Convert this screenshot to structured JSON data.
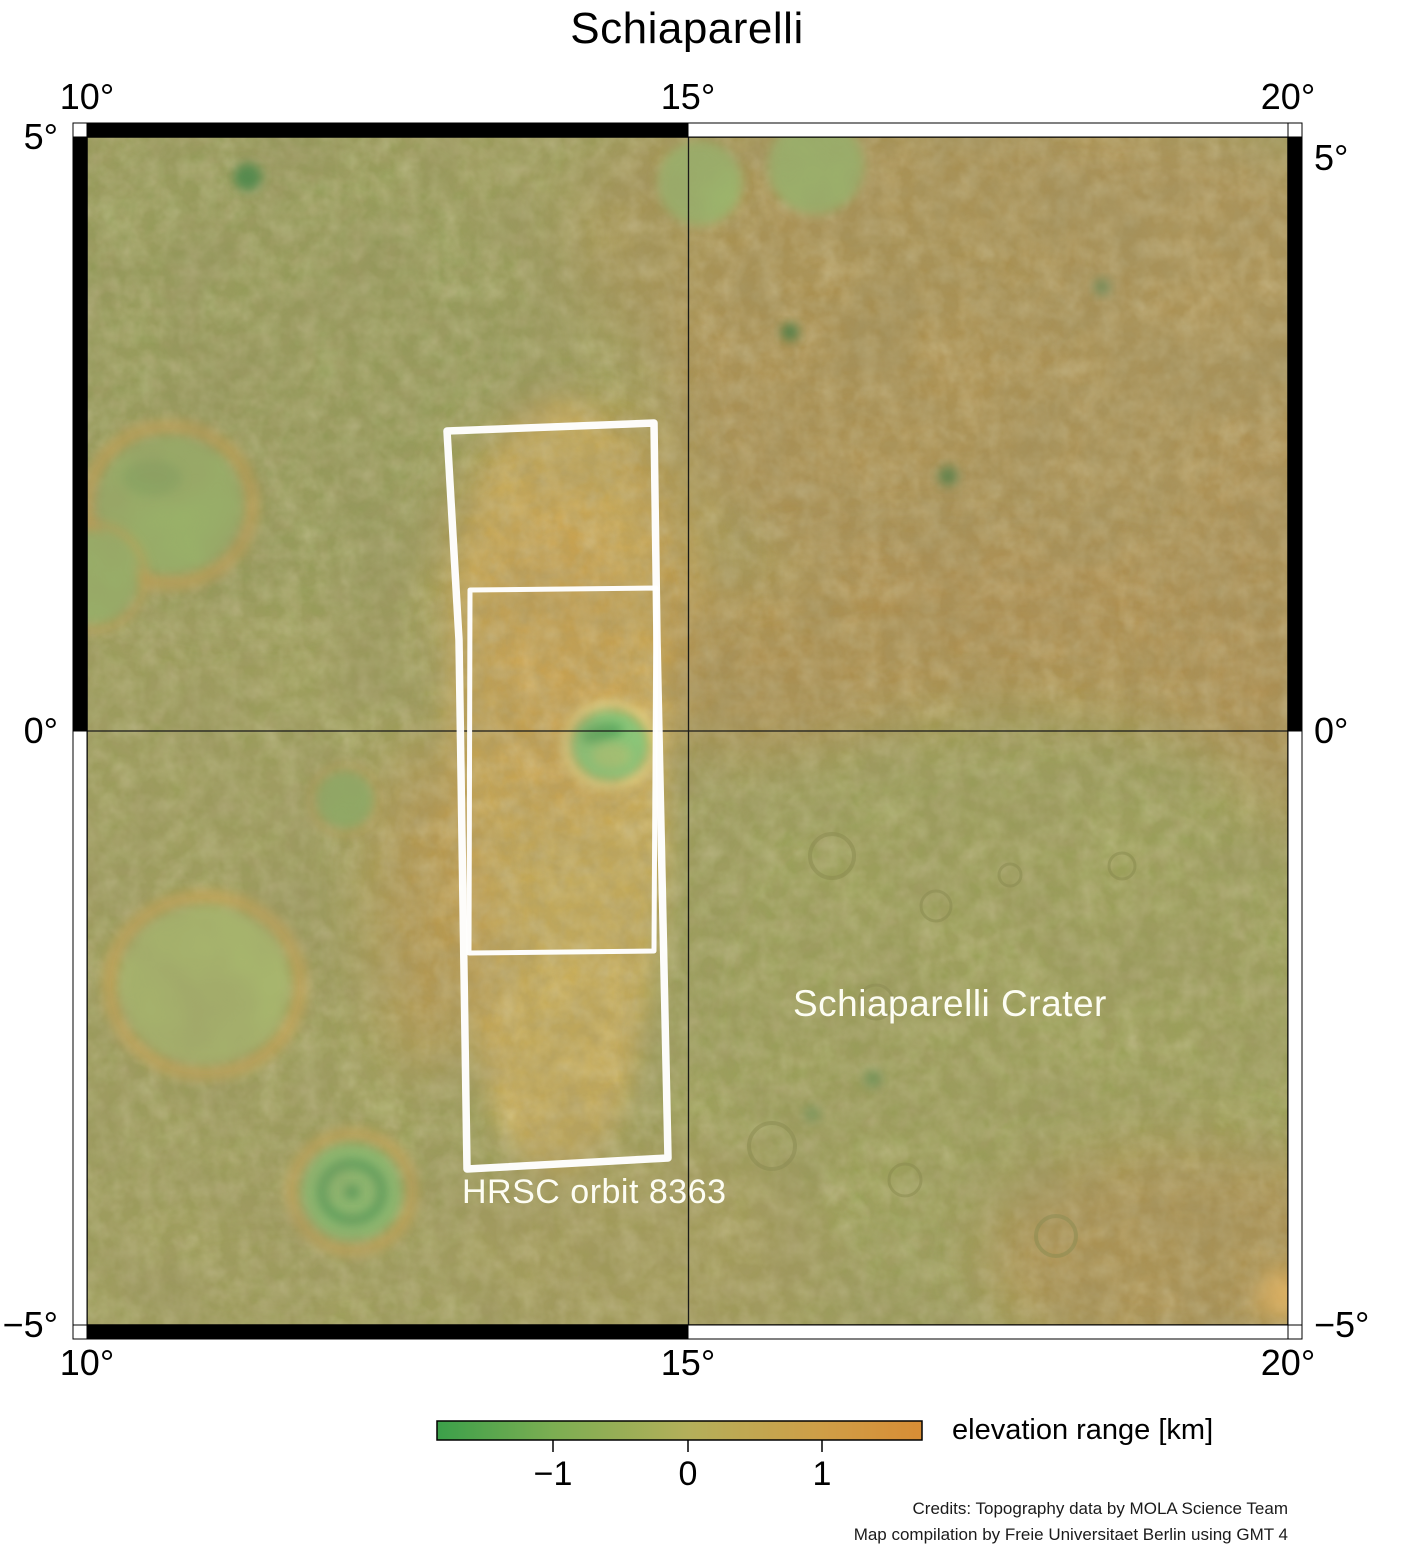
{
  "title": "Schiaparelli",
  "axis": {
    "top": [
      "10°",
      "15°",
      "20°"
    ],
    "bottom": [
      "10°",
      "15°",
      "20°"
    ],
    "left": [
      "5°",
      "0°",
      "−5°"
    ],
    "right": [
      "5°",
      "0°",
      "−5°"
    ]
  },
  "map": {
    "crater_label": "Schiaparelli Crater",
    "orbit_label": "HRSC orbit 8363",
    "footprint_outline_color": "#ffffff",
    "gridlines": [
      "0°",
      "15°"
    ]
  },
  "colorbar": {
    "label": "elevation range [km]",
    "ticks": [
      "−1",
      "0",
      "1"
    ],
    "color_low": "#3ba04a",
    "color_mid": "#b4af5a",
    "color_high": "#d88d35"
  },
  "credits": {
    "line1": "Credits: Topography data by MOLA Science Team",
    "line2": "Map compilation by Freie Universitaet Berlin using GMT 4"
  }
}
